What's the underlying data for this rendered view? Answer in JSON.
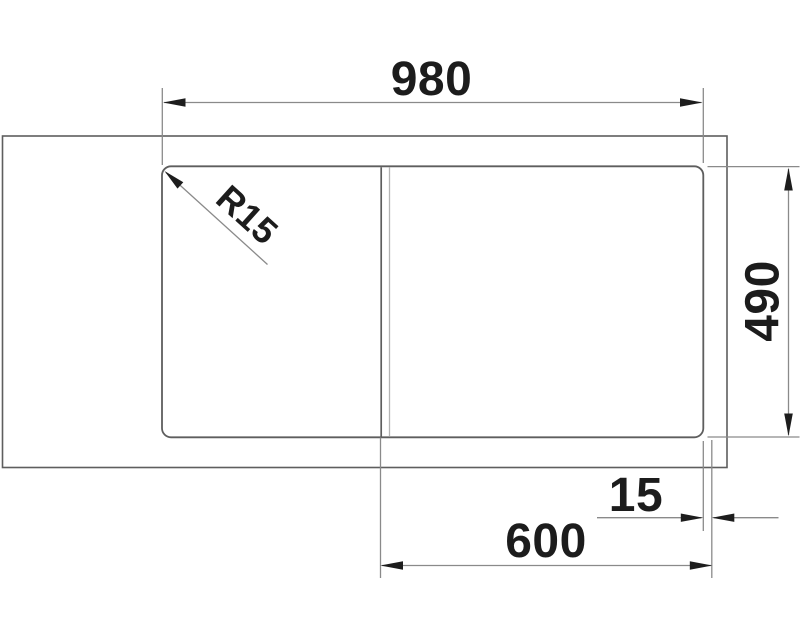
{
  "drawing": {
    "dimension_labels": {
      "overall_width": "980",
      "overall_depth": "490",
      "rim_offset": "15",
      "bowl_cabinet_width": "600",
      "corner_radius": "R15"
    },
    "colors": {
      "background": "#ffffff",
      "outline": "#5e5e5e",
      "divider_light": "#b4b4b4",
      "dimension_line": "#8a8a8a",
      "arrow": "#1d1d1d",
      "text": "#1c1c1c"
    }
  }
}
